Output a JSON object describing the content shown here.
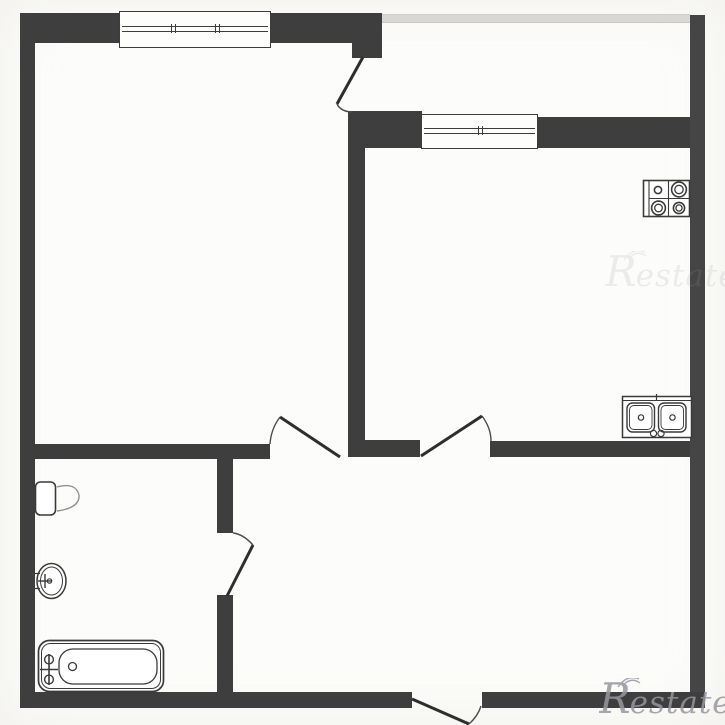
{
  "document": {
    "kind": "floor-plan"
  },
  "watermark": {
    "text": "Restate",
    "initial": "R",
    "rest": "estate"
  },
  "colors": {
    "wall": "#3e3e3e",
    "wall_light": "#454545",
    "balcony_parapet": "#d9d8d4",
    "background": "#fcfcfa",
    "fixture_line": "#3a3a3a",
    "watermark": "#97979f"
  },
  "icons": [
    "stove-icon",
    "kitchen-double-sink-icon",
    "bathtub-icon",
    "washbasin-icon",
    "toilet-icon",
    "window-icon",
    "door-swing-icon"
  ]
}
